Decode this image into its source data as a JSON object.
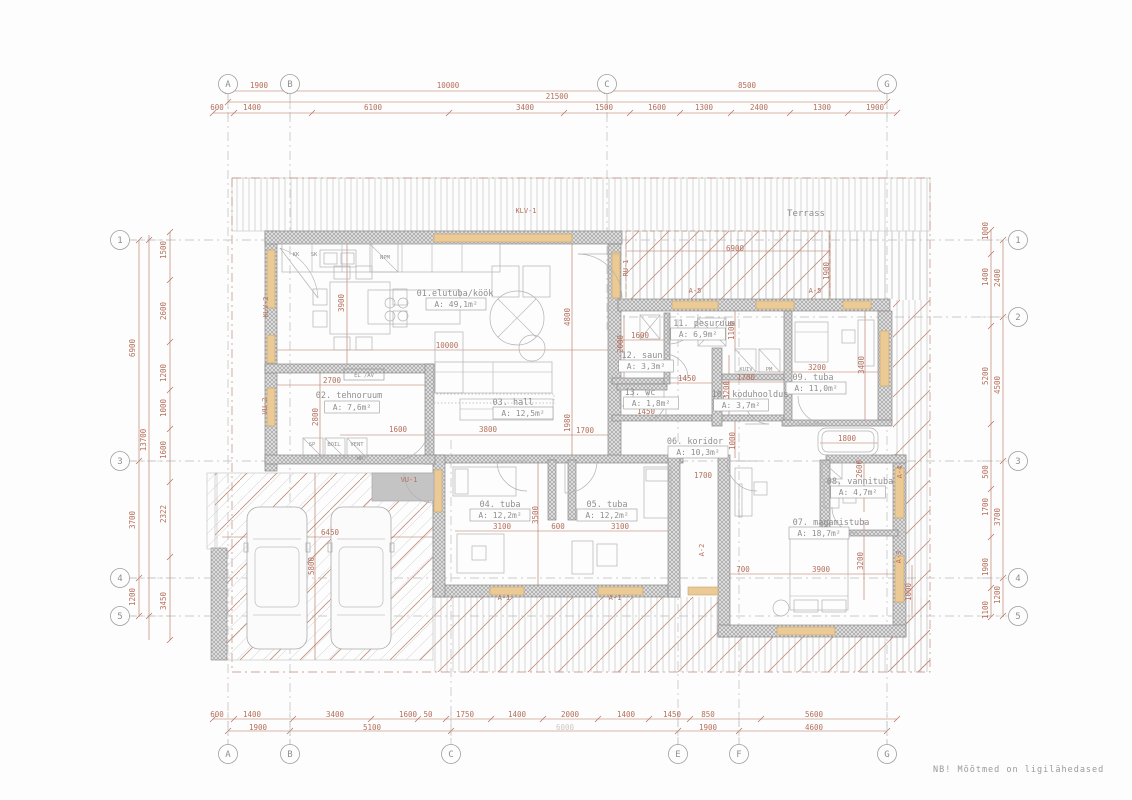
{
  "note": "NB!  Mõõtmed  on  ligilähedased",
  "colors": {
    "dim": "#b5705c",
    "gray_text": "#8f8f8f",
    "wall_stroke": "#8a8a8a",
    "window": "#ecca96",
    "window_stroke": "#c7a36f",
    "furniture": "#b2b2b2",
    "grid_dash": "#bcbcbc",
    "roof_line": "#c9c9c9",
    "terrace_red": "#c28d7e",
    "door_gray": "#c4c4c4",
    "faint": "#cfc8c4"
  },
  "grid": {
    "top": [
      {
        "label": "A",
        "x": 228
      },
      {
        "label": "B",
        "x": 290
      },
      {
        "label": "C",
        "x": 607
      },
      {
        "label": "G",
        "x": 887
      }
    ],
    "bottom": [
      {
        "label": "A",
        "x": 228
      },
      {
        "label": "B",
        "x": 290
      },
      {
        "label": "C",
        "x": 451
      },
      {
        "label": "E",
        "x": 678
      },
      {
        "label": "F",
        "x": 739
      },
      {
        "label": "G",
        "x": 887
      }
    ],
    "left": [
      {
        "label": "1",
        "y": 240
      },
      {
        "label": "3",
        "y": 461
      },
      {
        "label": "4",
        "y": 578
      },
      {
        "label": "5",
        "y": 616
      }
    ],
    "right": [
      {
        "label": "1",
        "y": 240
      },
      {
        "label": "2",
        "y": 317
      },
      {
        "label": "3",
        "y": 461
      },
      {
        "label": "4",
        "y": 578
      },
      {
        "label": "5",
        "y": 616
      }
    ]
  },
  "rooms": [
    {
      "label": "01.elutuba/köök",
      "area": "A:  49,1m²",
      "lx": 455,
      "ly": 296,
      "ax": 456,
      "ay": 307
    },
    {
      "label": "02. tehnoruum",
      "area": "A:  7,6m²",
      "lx": 349,
      "ly": 398,
      "ax": 352,
      "ay": 410
    },
    {
      "label": "03. hall",
      "area": "A:  12,5m²",
      "lx": 513,
      "ly": 405,
      "ax": 523,
      "ay": 416
    },
    {
      "label": "04. tuba",
      "area": "A:  12,2m²",
      "lx": 500,
      "ly": 507,
      "ax": 500,
      "ay": 518
    },
    {
      "label": "05. tuba",
      "area": "A:  12,2m²",
      "lx": 607,
      "ly": 507,
      "ax": 607,
      "ay": 518
    },
    {
      "label": "06. koridor",
      "area": "A:  10,3m²",
      "lx": 695,
      "ly": 444,
      "ax": 698,
      "ay": 455
    },
    {
      "label": "07. magamistuba",
      "area": "A:  18,7m²",
      "lx": 831,
      "ly": 525,
      "ax": 819,
      "ay": 536
    },
    {
      "label": "08. vannituba",
      "area": "A:  4,7m²",
      "lx": 860,
      "ly": 484,
      "ax": 858,
      "ay": 495
    },
    {
      "label": "09. tuba",
      "area": "A:  11,0m²",
      "lx": 813,
      "ly": 380,
      "ax": 816,
      "ay": 391
    },
    {
      "label": "10. koduhooldus",
      "area": "A:  3,7m²",
      "lx": 750,
      "ly": 397,
      "ax": 741,
      "ay": 408
    },
    {
      "label": "11. pesuruum",
      "area": "A:  6,9m²",
      "lx": 704,
      "ly": 326,
      "ax": 698,
      "ay": 337
    },
    {
      "label": "12. saun",
      "area": "A:  3,3m²",
      "lx": 642,
      "ly": 358,
      "ax": 646,
      "ay": 369
    },
    {
      "label": "13. wc",
      "area": "A:  1,8m²",
      "lx": 640,
      "ly": 395,
      "ax": 651,
      "ay": 406
    }
  ],
  "dims": [
    [
      "1900",
      259,
      88
    ],
    [
      "10000",
      448,
      88
    ],
    [
      "8500",
      747,
      88
    ],
    [
      "21500",
      557,
      99
    ],
    [
      "600",
      217,
      110
    ],
    [
      "1400",
      252,
      110
    ],
    [
      "6100",
      373,
      110
    ],
    [
      "3400",
      525,
      110
    ],
    [
      "1500",
      604,
      110
    ],
    [
      "1600",
      657,
      110
    ],
    [
      "1300",
      704,
      110
    ],
    [
      "2400",
      759,
      110
    ],
    [
      "1300",
      822,
      110
    ],
    [
      "1900",
      875,
      110
    ],
    [
      "600",
      217,
      717
    ],
    [
      "1400",
      252,
      717
    ],
    [
      "3400",
      335,
      717
    ],
    [
      "1600",
      408,
      717
    ],
    [
      "50",
      428,
      717
    ],
    [
      "1750",
      465,
      717
    ],
    [
      "1400",
      517,
      717
    ],
    [
      "2000",
      570,
      717
    ],
    [
      "1400",
      626,
      717
    ],
    [
      "1450",
      672,
      717
    ],
    [
      "850",
      708,
      717
    ],
    [
      "5600",
      814,
      717
    ],
    [
      "1900",
      258,
      730
    ],
    [
      "5100",
      372,
      730
    ],
    [
      "6000",
      565,
      730,
      0,
      1
    ],
    [
      "1900",
      708,
      730
    ],
    [
      "4600",
      814,
      730
    ],
    [
      "6900",
      135,
      348,
      1
    ],
    [
      "3700",
      135,
      520,
      1
    ],
    [
      "1200",
      135,
      597,
      1
    ],
    [
      "13700",
      146,
      440,
      1
    ],
    [
      "1500",
      166,
      250,
      1
    ],
    [
      "2600",
      166,
      311,
      1
    ],
    [
      "1200",
      166,
      373,
      1
    ],
    [
      "1000",
      166,
      408,
      1
    ],
    [
      "1600",
      166,
      450,
      1
    ],
    [
      "2322",
      166,
      514,
      1
    ],
    [
      "3450",
      166,
      601,
      1
    ],
    [
      "1000",
      988,
      231,
      1
    ],
    [
      "1400",
      988,
      277,
      1
    ],
    [
      "5200",
      988,
      376,
      1
    ],
    [
      "500",
      988,
      472,
      1
    ],
    [
      "1700",
      988,
      507,
      1
    ],
    [
      "1900",
      988,
      567,
      1
    ],
    [
      "1100",
      988,
      610,
      1
    ],
    [
      "2400",
      1000,
      278,
      1
    ],
    [
      "4500",
      1000,
      385,
      1
    ],
    [
      "3700",
      1000,
      517,
      1
    ],
    [
      "1200",
      1000,
      595,
      1
    ],
    [
      "3900",
      344,
      303,
      1
    ],
    [
      "10000",
      447,
      348
    ],
    [
      "4800",
      570,
      317,
      1
    ],
    [
      "1980",
      570,
      423,
      1
    ],
    [
      "2700",
      332,
      383
    ],
    [
      "2800",
      318,
      417,
      1
    ],
    [
      "1600",
      398,
      432
    ],
    [
      "3800",
      488,
      432
    ],
    [
      "1700",
      585,
      433
    ],
    [
      "1600",
      640,
      338
    ],
    [
      "2000",
      623,
      344,
      1
    ],
    [
      "1100",
      734,
      331,
      1
    ],
    [
      "1450",
      687,
      381
    ],
    [
      "1700",
      746,
      380
    ],
    [
      "3200",
      817,
      370
    ],
    [
      "3400",
      864,
      365,
      1
    ],
    [
      "3200",
      729,
      390,
      1
    ],
    [
      "1450",
      646,
      414
    ],
    [
      "1000",
      735,
      441,
      1
    ],
    [
      "1800",
      847,
      441
    ],
    [
      "2600",
      862,
      469,
      1
    ],
    [
      "1700",
      703,
      478
    ],
    [
      "3100",
      502,
      529
    ],
    [
      "600",
      558,
      529
    ],
    [
      "3100",
      620,
      529
    ],
    [
      "3500",
      538,
      515,
      1
    ],
    [
      "700",
      743,
      572
    ],
    [
      "3900",
      821,
      572
    ],
    [
      "3200",
      863,
      561,
      1
    ],
    [
      "1000",
      911,
      592,
      1
    ],
    [
      "6450",
      330,
      535
    ],
    [
      "5800",
      314,
      566,
      1
    ],
    [
      "6900",
      735,
      251
    ],
    [
      "1900",
      829,
      271,
      1
    ]
  ],
  "tags": [
    [
      "KLV-1",
      526,
      213
    ],
    [
      "KLV-2",
      268,
      307,
      1
    ],
    [
      "RU-1",
      628,
      268,
      1
    ],
    [
      "VU-1",
      409,
      482
    ],
    [
      "VU-2",
      267,
      406,
      1
    ],
    [
      "A-5",
      695,
      293
    ],
    [
      "A-5",
      815,
      293
    ],
    [
      "A-1",
      504,
      600
    ],
    [
      "A-1",
      615,
      600
    ],
    [
      "A-2",
      704,
      550,
      1
    ],
    [
      "A-4",
      902,
      472,
      1
    ],
    [
      "A-3",
      901,
      557,
      1
    ]
  ],
  "small_labels": [
    [
      "Terrass",
      806,
      216,
      9
    ],
    [
      "KK",
      296,
      256
    ],
    [
      "SK",
      314,
      256
    ],
    [
      "NPM",
      385,
      259
    ],
    [
      "EL /AV",
      364,
      377
    ],
    [
      "SP",
      312,
      446
    ],
    [
      "BOIL",
      334,
      446
    ],
    [
      "VENT",
      357,
      446
    ],
    [
      "WD",
      360,
      460
    ],
    [
      "KUIV",
      746,
      371
    ],
    [
      "PM",
      769,
      371
    ]
  ]
}
